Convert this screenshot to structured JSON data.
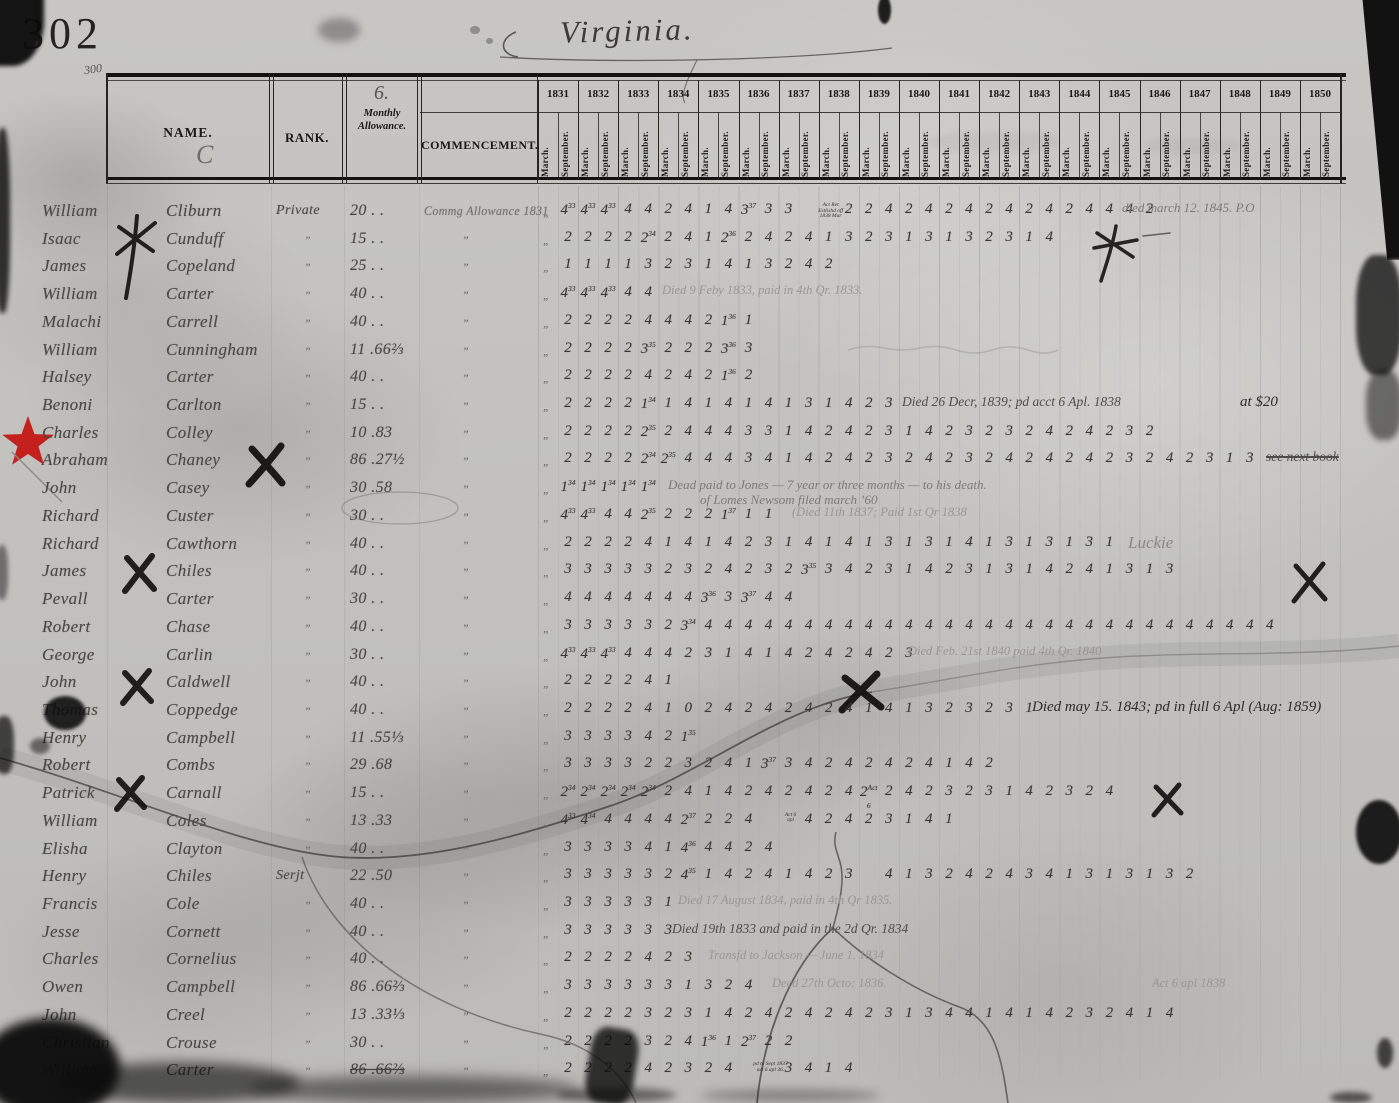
{
  "page": {
    "number": "302",
    "margin_note": "300",
    "title": "Virginia."
  },
  "table": {
    "headers": {
      "name": "NAME.",
      "name_flourish": "C",
      "rank": "RANK.",
      "allowance_no": "6.",
      "allowance_l1": "Monthly",
      "allowance_l2": "Allowance.",
      "commencement": "COMMENCEMENT.",
      "months": [
        "March.",
        "September."
      ],
      "years": [
        "1831",
        "1832",
        "1833",
        "1834",
        "1835",
        "1836",
        "1837",
        "1838",
        "1839",
        "1840",
        "1841",
        "1842",
        "1843",
        "1844",
        "1845",
        "1846",
        "1847",
        "1848",
        "1849",
        "1850"
      ]
    },
    "rows": [
      {
        "given": "William",
        "surname": "Cliburn",
        "rank": "Private",
        "allowance": "20 . .",
        "commencement": "Commg Allowance 1831",
        "digits": [
          "4^33",
          "4^33",
          "4^33",
          "4",
          "4",
          "2",
          "4",
          "1",
          "4",
          "3^37",
          "3",
          "3",
          "~Act Ret/Estlishd off/1838 Mar",
          "2",
          "2",
          "4",
          "2",
          "4",
          "2",
          "4",
          "2",
          "4",
          "2",
          "4",
          "2",
          "4",
          "4",
          "4",
          "2"
        ],
        "notes": [
          {
            "x": 1122,
            "text": "died march 12. 1845.  P.O",
            "cls": "pencil"
          }
        ]
      },
      {
        "given": "Isaac",
        "surname": "Cunduff",
        "rank": "”",
        "allowance": "15 . .",
        "commencement": "”",
        "digits": [
          "2",
          "2",
          "2",
          "2",
          "2^34",
          "2",
          "4",
          "1",
          "2^36",
          "2",
          "4",
          "2",
          "4",
          "1",
          "3",
          "2",
          "3",
          "1",
          "3",
          "1",
          "3",
          "2",
          "3",
          "1",
          "4"
        ]
      },
      {
        "given": "James",
        "surname": "Copeland",
        "rank": "”",
        "allowance": "25 . .",
        "commencement": "”",
        "digits": [
          "1",
          "1",
          "1",
          "1",
          "3",
          "2",
          "3",
          "1",
          "4",
          "1",
          "3",
          "2",
          "4",
          "2"
        ]
      },
      {
        "given": "William",
        "surname": "Carter",
        "rank": "”",
        "allowance": "40 . .",
        "commencement": "”",
        "digits": [
          "4^33",
          "4^33",
          "4^33",
          "4",
          "4"
        ],
        "notes": [
          {
            "x": 662,
            "text": "Died 9 Feby 1833, paid in 4th Qr. 1833.",
            "cls": "faint"
          }
        ]
      },
      {
        "given": "Malachi",
        "surname": "Carrell",
        "rank": "”",
        "allowance": "40 . .",
        "commencement": "”",
        "digits": [
          "2",
          "2",
          "2",
          "2",
          "4",
          "4",
          "4",
          "2",
          "1^36",
          "1"
        ]
      },
      {
        "given": "William",
        "surname": "Cunningham",
        "rank": "”",
        "allowance": "11 .66⅔",
        "commencement": "”",
        "digits": [
          "2",
          "2",
          "2",
          "2",
          "3^35",
          "2",
          "2",
          "2",
          "3^36",
          "3"
        ]
      },
      {
        "given": "Halsey",
        "surname": "Carter",
        "rank": "”",
        "allowance": "40 . .",
        "commencement": "”",
        "digits": [
          "2",
          "2",
          "2",
          "2",
          "4",
          "2",
          "4",
          "2",
          "1^36",
          "2"
        ]
      },
      {
        "given": "Benoni",
        "surname": "Carlton",
        "rank": "”",
        "allowance": "15 . .",
        "commencement": "”",
        "digits": [
          "2",
          "2",
          "2",
          "2",
          "1^34",
          "1",
          "4",
          "1",
          "4",
          "1",
          "4",
          "1",
          "3",
          "1",
          "4",
          "2",
          "3"
        ],
        "notes": [
          {
            "x": 902,
            "text": "Died 26 Decr, 1839; pd acct 6 Apl. 1838",
            "cls": "ink"
          },
          {
            "x": 1240,
            "text": "at $20",
            "cls": "ink2"
          }
        ]
      },
      {
        "given": "Charles",
        "surname": "Colley",
        "rank": "”",
        "allowance": "10 .83",
        "commencement": "”",
        "digits": [
          "2",
          "2",
          "2",
          "2",
          "2^35",
          "2",
          "4",
          "4",
          "4",
          "3",
          "3",
          "1",
          "4",
          "2",
          "4",
          "2",
          "3",
          "1",
          "4",
          "2",
          "3",
          "2",
          "3",
          "2",
          "4",
          "2",
          "4",
          "2",
          "3",
          "2"
        ]
      },
      {
        "given": "Abraham",
        "surname": "Chaney",
        "rank": "”",
        "allowance": "86 .27½",
        "commencement": "”",
        "digits": [
          "2",
          "2",
          "2",
          "2",
          "2^34",
          "2^35",
          "4",
          "4",
          "4",
          "3",
          "4",
          "1",
          "4",
          "2",
          "4",
          "2",
          "3",
          "2",
          "4",
          "2",
          "3",
          "2",
          "4",
          "2",
          "4",
          "2",
          "4",
          "2",
          "3",
          "2",
          "4",
          "2",
          "3",
          "1",
          "3"
        ],
        "notes": [
          {
            "x": 1266,
            "text": "see next book",
            "cls": "ink",
            "strike": true
          }
        ]
      },
      {
        "given": "John",
        "surname": "Casey",
        "rank": "”",
        "allowance": "30 .58",
        "commencement": "”",
        "digits": [
          "1^34",
          "1^34",
          "1^34",
          "1^34",
          "1^34"
        ],
        "notes": [
          {
            "x": 668,
            "text": "Dead   paid to Jones — 7 year or three months — to his death.",
            "cls": "pencil"
          },
          {
            "x": 700,
            "dy": 15,
            "text": "of Lomes Newsom filed march ’60",
            "cls": "pencil"
          }
        ]
      },
      {
        "given": "Richard",
        "surname": "Custer",
        "rank": "”",
        "allowance": "30 . .",
        "commencement": "”",
        "digits": [
          "4^33",
          "4^33",
          "4",
          "4",
          "2^35",
          "2",
          "2",
          "2",
          "1^37",
          "1",
          "1"
        ],
        "notes": [
          {
            "x": 792,
            "text": "(Died 11th 1837;  Paid 1st Qr 1838",
            "cls": "faint"
          }
        ]
      },
      {
        "given": "Richard",
        "surname": "Cawthorn",
        "rank": "”",
        "allowance": "40 . .",
        "commencement": "”",
        "digits": [
          "2",
          "2",
          "2",
          "2",
          "4",
          "1",
          "4",
          "1",
          "4",
          "2",
          "3",
          "1",
          "4",
          "1",
          "4",
          "1",
          "3",
          "1",
          "3",
          "1",
          "4",
          "1",
          "3",
          "1",
          "3",
          "1",
          "3",
          "1"
        ],
        "notes": [
          {
            "x": 1128,
            "text": "Luckie",
            "cls": "big"
          }
        ]
      },
      {
        "given": "James",
        "surname": "Chiles",
        "rank": "”",
        "allowance": "40 . .",
        "commencement": "”",
        "digits": [
          "3",
          "3",
          "3",
          "3",
          "3",
          "2",
          "3",
          "2",
          "4",
          "2",
          "3",
          "2",
          "3^35",
          "3",
          "4",
          "2",
          "3",
          "1",
          "4",
          "2",
          "3",
          "1",
          "3",
          "1",
          "4",
          "2",
          "4",
          "1",
          "3",
          "1",
          "3"
        ]
      },
      {
        "given": "Pevall",
        "surname": "Carter",
        "rank": "”",
        "allowance": "30 . .",
        "commencement": "”",
        "digits": [
          "4",
          "4",
          "4",
          "4",
          "4",
          "4",
          "4",
          "3^36",
          "3",
          "3^37",
          "4",
          "4"
        ]
      },
      {
        "given": "Robert",
        "surname": "Chase",
        "rank": "”",
        "allowance": "40 . .",
        "commencement": "”",
        "digits": [
          "3",
          "3",
          "3",
          "3",
          "3",
          "2",
          "3^34",
          "4",
          "4",
          "4",
          "4",
          "4",
          "4",
          "4",
          "4",
          "4",
          "4",
          "4",
          "4",
          "4",
          "4",
          "4",
          "4",
          "4",
          "4",
          "4",
          "4",
          "4",
          "4",
          "4",
          "4",
          "4",
          "4",
          "4",
          "4",
          "4"
        ]
      },
      {
        "given": "George",
        "surname": "Carlin",
        "rank": "”",
        "allowance": "30 . .",
        "commencement": "”",
        "digits": [
          "4^33",
          "4^33",
          "4^33",
          "4",
          "4",
          "4",
          "2",
          "3",
          "1",
          "4",
          "1",
          "4",
          "2",
          "4",
          "2",
          "4",
          "2",
          "3"
        ],
        "notes": [
          {
            "x": 908,
            "text": "Died Feb. 21st 1840   paid 4th Qr. 1840",
            "cls": "faint"
          }
        ]
      },
      {
        "given": "John",
        "surname": "Caldwell",
        "rank": "”",
        "allowance": "40 . .",
        "commencement": "”",
        "digits": [
          "2",
          "2",
          "2",
          "2",
          "4",
          "1"
        ]
      },
      {
        "given": "Thomas",
        "surname": "Coppedge",
        "rank": "”",
        "allowance": "40 . .",
        "commencement": "”",
        "digits": [
          "2",
          "2",
          "2",
          "2",
          "4",
          "1",
          "0",
          "2",
          "4",
          "2",
          "4",
          "2",
          "4",
          "2",
          "4",
          "1",
          "4",
          "1",
          "3",
          "2",
          "3",
          "2",
          "3",
          "1"
        ],
        "notes": [
          {
            "x": 1032,
            "text": "Died may 15. 1843; pd in full 6 Apl (Aug: 1859)",
            "cls": "ink2"
          }
        ]
      },
      {
        "given": "Henry",
        "surname": "Campbell",
        "rank": "”",
        "allowance": "11 .55⅓",
        "commencement": "”",
        "digits": [
          "3",
          "3",
          "3",
          "3",
          "4",
          "2",
          "1^35"
        ]
      },
      {
        "given": "Robert",
        "surname": "Combs",
        "rank": "”",
        "allowance": "29 .68",
        "commencement": "”",
        "digits": [
          "3",
          "3",
          "3",
          "3",
          "2",
          "2",
          "3",
          "2",
          "4",
          "1",
          "3^37",
          "3",
          "4",
          "2",
          "4",
          "2",
          "4",
          "2",
          "4",
          "1",
          "4",
          "2"
        ]
      },
      {
        "given": "Patrick",
        "surname": "Carnall",
        "rank": "”",
        "allowance": "15 . .",
        "commencement": "”",
        "digits": [
          "2^34",
          "2^34",
          "2^34",
          "2^34",
          "2^34",
          "2",
          "4",
          "1",
          "4",
          "2",
          "4",
          "2",
          "4",
          "2",
          "4",
          "2^Act 6",
          "2",
          "4",
          "2",
          "3",
          "2",
          "3",
          "1",
          "4",
          "2",
          "3",
          "2",
          "4"
        ]
      },
      {
        "given": "William",
        "surname": "Coles",
        "rank": "”",
        "allowance": "13 .33",
        "commencement": "”",
        "digits": [
          "4^33",
          "4^34",
          "4",
          "4",
          "4",
          "4",
          "2^37",
          "2",
          "2",
          "4",
          "~Act 6/apl",
          "4",
          "2",
          "4",
          "2",
          "3",
          "1",
          "4",
          "1"
        ]
      },
      {
        "given": "Elisha",
        "surname": "Clayton",
        "rank": "”",
        "allowance": "40 . .",
        "commencement": "”",
        "digits": [
          "3",
          "3",
          "3",
          "3",
          "4",
          "1",
          "4^36",
          "4",
          "4",
          "2",
          "4"
        ]
      },
      {
        "given": "Henry",
        "surname": "Chiles",
        "rank": "Serjt",
        "allowance": "22 .50",
        "commencement": "”",
        "digits": [
          "3",
          "3",
          "3",
          "3",
          "3",
          "2",
          "4^35",
          "1",
          "4",
          "2",
          "4",
          "1",
          "4",
          "2",
          "3",
          "",
          "4",
          "1",
          "3",
          "2",
          "4",
          "2",
          "4",
          "3",
          "4",
          "1",
          "3",
          "1",
          "3",
          "1",
          "3",
          "2"
        ]
      },
      {
        "given": "Francis",
        "surname": "Cole",
        "rank": "”",
        "allowance": "40 . .",
        "commencement": "”",
        "digits": [
          "3",
          "3",
          "3",
          "3",
          "3",
          "1"
        ],
        "notes": [
          {
            "x": 678,
            "text": "Died 17 August 1834, paid in 4th Qr 1835.",
            "cls": "faint"
          }
        ]
      },
      {
        "given": "Jesse",
        "surname": "Cornett",
        "rank": "”",
        "allowance": "40 . .",
        "commencement": "”",
        "digits": [
          "3",
          "3",
          "3",
          "3",
          "3",
          "3"
        ],
        "notes": [
          {
            "x": 672,
            "text": "Died 19th 1833 and paid in the 2d Qr. 1834",
            "cls": "ink"
          }
        ]
      },
      {
        "given": "Charles",
        "surname": "Cornelius",
        "rank": "”",
        "allowance": "40 . .",
        "commencement": "”",
        "digits": [
          "2",
          "2",
          "2",
          "2",
          "4",
          "2",
          "3"
        ],
        "notes": [
          {
            "x": 708,
            "text": "Transfd to Jackson —  June 1.  1834",
            "cls": "faint"
          }
        ]
      },
      {
        "given": "Owen",
        "surname": "Campbell",
        "rank": "”",
        "allowance": "86 .66⅔",
        "commencement": "”",
        "digits": [
          "3",
          "3",
          "3",
          "3",
          "3",
          "3",
          "1",
          "3",
          "2",
          "4"
        ],
        "notes": [
          {
            "x": 772,
            "text": "Decd 27th Octo: 1836.",
            "cls": "faint"
          },
          {
            "x": 1152,
            "text": "Act 6 apl 1838",
            "cls": "faint"
          }
        ]
      },
      {
        "given": "John",
        "surname": "Creel",
        "rank": "”",
        "allowance": "13 .33⅓",
        "commencement": "”",
        "digits": [
          "2",
          "2",
          "2",
          "2",
          "3",
          "2",
          "3",
          "1",
          "4",
          "2",
          "4",
          "2",
          "4",
          "2",
          "4",
          "2",
          "3",
          "1",
          "3",
          "4",
          "4",
          "1",
          "4",
          "1",
          "4",
          "2",
          "3",
          "2",
          "4",
          "1",
          "4"
        ]
      },
      {
        "given": "Christian",
        "surname": "Crouse",
        "rank": "”",
        "allowance": "30 . .",
        "commencement": "”",
        "digits": [
          "2",
          "2",
          "2",
          "2",
          "3",
          "2",
          "4",
          "1^36",
          "1",
          "2^37",
          "2",
          "2"
        ]
      },
      {
        "given": "William",
        "surname": "Carter",
        "rank": "”",
        "allowance": "86 .66⅔",
        "allowStrike": true,
        "commencement": "”",
        "digits": [
          "2",
          "2",
          "2",
          "2",
          "4",
          "2",
          "3",
          "2",
          "4",
          "~pd to Sept 1837/act 6 apl 36.",
          "3",
          "4",
          "1",
          "4"
        ]
      }
    ]
  }
}
